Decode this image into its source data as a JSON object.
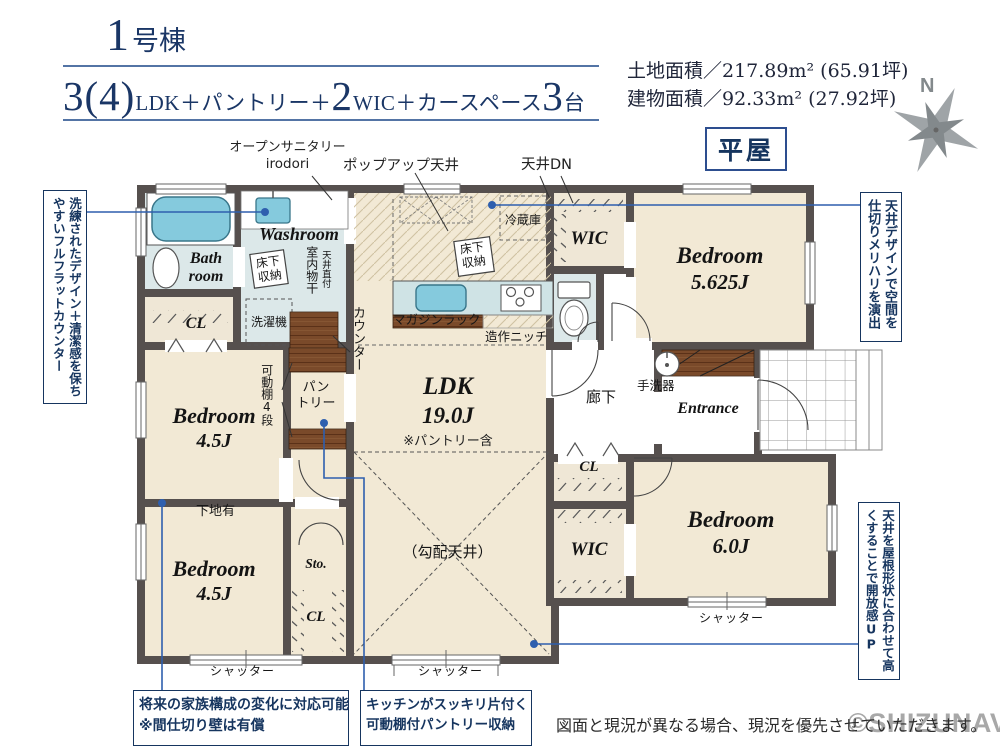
{
  "header": {
    "unit_number": "1",
    "unit_suffix": "号棟",
    "layout_segments": {
      "s1": "3(4)",
      "s2": "LDK＋パントリー＋",
      "s3": "2",
      "s4": "WIC＋カースペース",
      "s5": "3",
      "s6": "台"
    },
    "land_area": "土地面積／217.89m² (65.91坪)",
    "building_area": "建物面積／92.33m² (27.92坪)",
    "badge": "平屋",
    "compass_n": "N"
  },
  "plan": {
    "rooms": {
      "bedroom_word": "Bedroom",
      "size_ne": "5.625J",
      "size_w1": "4.5J",
      "size_w2": "4.5J",
      "size_se": "6.0J",
      "ldk": "LDK",
      "ldk_size": "19.0J",
      "ldk_note": "※パントリー含",
      "washroom": "Washroom",
      "bath_line1": "Bath",
      "bath_line2": "room",
      "wic": "WIC",
      "cl": "CL",
      "sto": "Sto.",
      "entrance": "Entrance",
      "hallway": "廊下",
      "pantry_line1": "パン",
      "pantry_line2": "トリー"
    },
    "labels": {
      "open_sanitary_line1": "オープンサニタリー",
      "open_sanitary_line2": "irodori",
      "popup_ceiling": "ポップアップ天井",
      "ceiling_down": "天井DN",
      "refrigerator": "冷蔵庫",
      "underfloor_storage": "床下収納",
      "washing_machine": "洗濯機",
      "indoor_drying": "室内物干",
      "ceiling_mounted": "天井直付",
      "magazine_rack": "マガジンラック",
      "built_in_niche": "造作ニッチ",
      "counter": "カウンター",
      "movable_shelf": "可動棚4段",
      "hand_wash": "手洗器",
      "wall_backing": "下地有",
      "sloped_ceiling": "（勾配天井）",
      "shutter": "シャッター"
    }
  },
  "annotations": {
    "left_note": "洗練されたデザイン＋清潔感を保ちやすいフルフラットカウンター",
    "right_top_note": "天井デザインで空間を仕切りメリハリを演出",
    "right_bottom_note": "天井を屋根形状に合わせて高くすることで開放感UP",
    "bottom_left_line1": "将来の家族構成の変化に対応可能",
    "bottom_left_line2": "※間仕切り壁は有償",
    "bottom_mid_line1": "キッチンがスッキリ片付く",
    "bottom_mid_line2": "可動棚付パントリー収納"
  },
  "footer": {
    "disclaimer": "図面と現況が異なる場合、現況を優先させていただきます。",
    "watermark": "©SHIZUNAVI"
  },
  "colors": {
    "navy": "#16355f",
    "leader_blue": "#2e5fae",
    "wall_gray": "#56504e",
    "floor_beige": "#f2e9d5",
    "wet_area_blue": "#dce8e9",
    "fixture_aqua": "#85cadd",
    "wood_brown": "#7a4a2a"
  }
}
